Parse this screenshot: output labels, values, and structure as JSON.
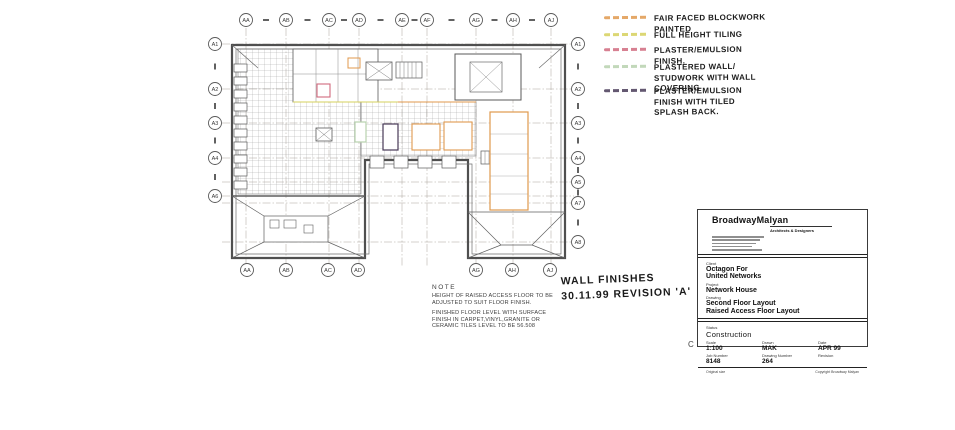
{
  "page": {
    "background": "#ffffff",
    "ink": "#4f4f4f"
  },
  "legend": {
    "items": [
      {
        "name": "fair-faced-blockwork-painted",
        "label": "FAIR FACED BLOCKWORK\nPAINTED",
        "color": "#e0994e"
      },
      {
        "name": "full-height-tiling",
        "label": "FULL HEIGHT TILING",
        "color": "#d6d05c"
      },
      {
        "name": "plaster-emulsion-finish",
        "label": "PLASTER/EMULSION\nFINISH.",
        "color": "#d06a7e"
      },
      {
        "name": "plastered-wall-studwork-wall-covering",
        "label": "PLASTERED WALL/\nSTUDWORK WITH WALL\nCOVERING",
        "color": "#b7d1ae"
      },
      {
        "name": "plaster-emulsion-tiled-splashback",
        "label": "PLASTER/EMULSION\nFINISH WITH TILED\nSPLASH BACK.",
        "color": "#483a58"
      }
    ]
  },
  "annotation": {
    "line1": "WALL FINISHES",
    "line2": "30.11.99 REVISION 'A'"
  },
  "note": {
    "title": "NOTE",
    "para1": "HEIGHT OF RAISED ACCESS FLOOR TO BE ADJUSTED TO SUIT FLOOR FINISH.",
    "para2": "FINISHED FLOOR LEVEL WITH SURFACE FINISH IN CARPET,VINYL,GRANITE OR CERAMIC TILES LEVEL TO BE 56.508"
  },
  "plan": {
    "grid_top": [
      "AA",
      "AB",
      "AC",
      "AD",
      "AE",
      "AF",
      "AG",
      "AH",
      "AJ"
    ],
    "grid_bottom_left": [
      "AA",
      "AB",
      "AC",
      "AD"
    ],
    "grid_bottom_right": [
      "AG",
      "AH",
      "AJ"
    ],
    "grid_left": [
      "A1",
      "A2",
      "A3",
      "A4",
      "A6"
    ],
    "grid_right": [
      "A1",
      "A2",
      "A3",
      "A4",
      "A5",
      "A7",
      "A8"
    ]
  },
  "titleblock": {
    "firm": "BroadwayMalyan",
    "firm_sub": "Architects & Designers",
    "client_label": "Client",
    "client_line1": "Octagon For",
    "client_line2": "United Networks",
    "project_label": "Project",
    "project": "Network House",
    "drawing_label": "Drawing",
    "drawing_line1": "Second Floor Layout",
    "drawing_line2": "Raised Access Floor Layout",
    "status_label": "Status",
    "status": "Construction",
    "scale_label": "Scale",
    "scale": "1:100",
    "drawn_label": "Drawn",
    "drawn": "MAK",
    "date_label": "Date",
    "date": "APR 99",
    "job_label": "Job Number",
    "job": "8148",
    "dwgno_label": "Drawing Number",
    "dwgno": "264",
    "rev_label": "Revision",
    "footer_left": "Original size",
    "footer_right": "Copyright Broadway Malyan",
    "corner_mark": "C"
  }
}
